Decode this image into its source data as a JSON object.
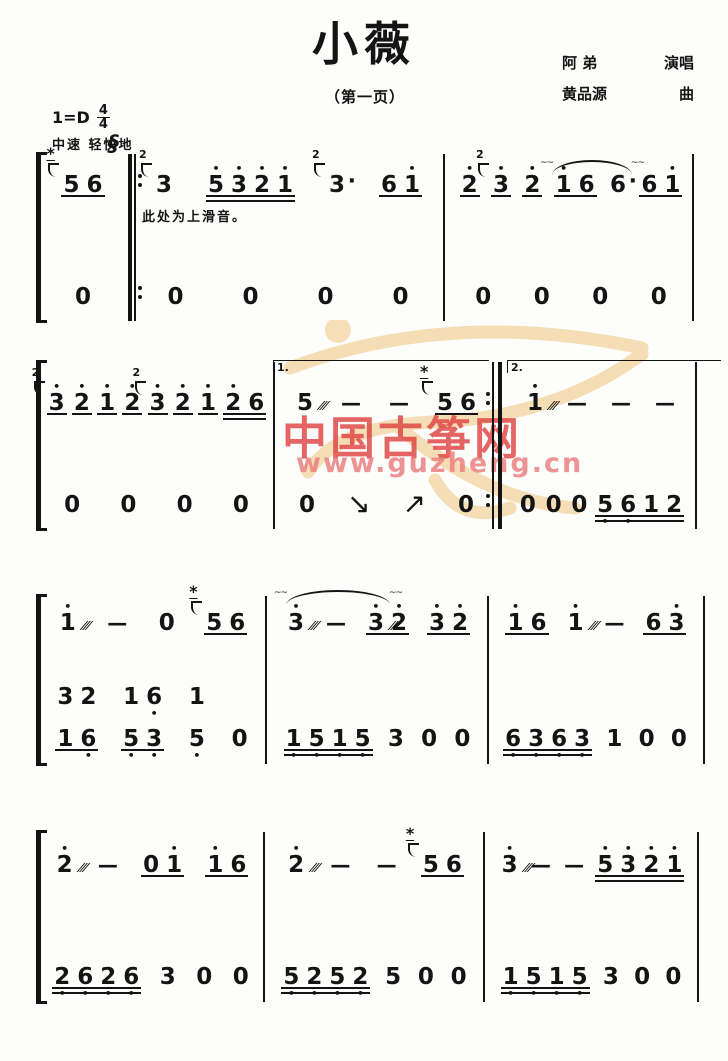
{
  "header": {
    "title": "小薇",
    "page_label": "（第一页）",
    "credits": [
      {
        "name": "阿  弟",
        "role": "演唱"
      },
      {
        "name": "黄品源",
        "role": "曲"
      }
    ],
    "key": "1=D",
    "time_num": "4",
    "time_den": "4",
    "tempo": "中速  轻快地"
  },
  "watermark": {
    "brand": "中国古筝网",
    "url": "www.guzheng.cn"
  },
  "systems": [
    {
      "annotation": "此处为上滑音。",
      "upper": [
        [
          {
            "ul": 1,
            "notes": [
              {
                "t": "5",
                "orn": 1,
                "lab": "*"
              },
              {
                "t": "6"
              }
            ]
          }
        ],
        [
          {
            "ul": 0,
            "notes": [
              {
                "t": "3",
                "orn": 1,
                "lab": "2"
              }
            ]
          },
          {
            "ul": 2,
            "notes": [
              {
                "t": "5",
                "hi": 1
              },
              {
                "t": "3",
                "hi": 1
              },
              {
                "t": "2",
                "hi": 1
              },
              {
                "t": "1",
                "hi": 1
              }
            ]
          },
          {
            "ul": 0,
            "notes": [
              {
                "t": "3",
                "orn": 1,
                "lab": "2",
                "aug": true
              }
            ]
          },
          {
            "ul": 1,
            "notes": [
              {
                "t": "6"
              },
              {
                "t": "1",
                "hi": 1
              }
            ]
          }
        ],
        [
          {
            "ul": 1,
            "notes": [
              {
                "t": "2",
                "hi": 1
              }
            ]
          },
          {
            "ul": 1,
            "notes": [
              {
                "t": "3",
                "hi": 1,
                "orn": 1,
                "lab": "2̇"
              }
            ]
          },
          {
            "ul": 1,
            "notes": [
              {
                "t": "2",
                "hi": 1
              }
            ]
          },
          {
            "ul": 1,
            "notes": [
              {
                "t": "1",
                "hi": 1
              },
              {
                "t": "6"
              }
            ]
          },
          {
            "ul": 0,
            "notes": [
              {
                "t": "6",
                "aug": true
              }
            ]
          },
          {
            "ul": 1,
            "notes": [
              {
                "t": "6"
              },
              {
                "t": "1",
                "hi": 1
              }
            ]
          }
        ]
      ],
      "lower": [
        [
          {
            "ul": 0,
            "notes": [
              {
                "t": "0"
              }
            ]
          }
        ],
        [
          {
            "ul": 0,
            "notes": [
              {
                "t": "0"
              }
            ]
          },
          {
            "ul": 0,
            "notes": [
              {
                "t": "0"
              }
            ]
          },
          {
            "ul": 0,
            "notes": [
              {
                "t": "0"
              }
            ]
          },
          {
            "ul": 0,
            "notes": [
              {
                "t": "0"
              }
            ]
          }
        ],
        [
          {
            "ul": 0,
            "notes": [
              {
                "t": "0"
              }
            ]
          },
          {
            "ul": 0,
            "notes": [
              {
                "t": "0"
              }
            ]
          },
          {
            "ul": 0,
            "notes": [
              {
                "t": "0"
              }
            ]
          },
          {
            "ul": 0,
            "notes": [
              {
                "t": "0"
              }
            ]
          }
        ]
      ]
    },
    {
      "voltas": [
        "1.",
        "2."
      ],
      "upper": [
        [
          {
            "ul": 1,
            "notes": [
              {
                "t": "3",
                "hi": 1,
                "orn": 1,
                "lab": "2"
              }
            ]
          },
          {
            "ul": 1,
            "notes": [
              {
                "t": "2",
                "hi": 1
              }
            ]
          },
          {
            "ul": 1,
            "notes": [
              {
                "t": "1",
                "hi": 1
              }
            ]
          },
          {
            "ul": 1,
            "notes": [
              {
                "t": "2",
                "hi": 1
              }
            ]
          },
          {
            "ul": 1,
            "notes": [
              {
                "t": "3",
                "hi": 1,
                "orn": 1,
                "lab": "2"
              }
            ]
          },
          {
            "ul": 1,
            "notes": [
              {
                "t": "2",
                "hi": 1
              }
            ]
          },
          {
            "ul": 1,
            "notes": [
              {
                "t": "1",
                "hi": 1
              }
            ]
          },
          {
            "ul": 2,
            "notes": [
              {
                "t": "2",
                "hi": 1
              },
              {
                "t": "6"
              }
            ]
          }
        ],
        [
          {
            "ul": 0,
            "notes": [
              {
                "t": "5",
                "trem": true
              }
            ]
          },
          {
            "ul": 0,
            "notes": [
              {
                "t": "—"
              }
            ]
          },
          {
            "ul": 0,
            "notes": [
              {
                "t": "—"
              }
            ]
          },
          {
            "ul": 1,
            "notes": [
              {
                "t": "5",
                "orn": 1,
                "lab": "*"
              },
              {
                "t": "6"
              }
            ]
          }
        ],
        [
          {
            "ul": 0,
            "notes": [
              {
                "t": "1",
                "hi": 1,
                "trem": true
              }
            ]
          },
          {
            "ul": 0,
            "notes": [
              {
                "t": "—"
              }
            ]
          },
          {
            "ul": 0,
            "notes": [
              {
                "t": "—"
              }
            ]
          },
          {
            "ul": 0,
            "notes": [
              {
                "t": "—"
              }
            ]
          }
        ]
      ],
      "lower": [
        [
          {
            "ul": 0,
            "notes": [
              {
                "t": "0"
              }
            ]
          },
          {
            "ul": 0,
            "notes": [
              {
                "t": "0"
              }
            ]
          },
          {
            "ul": 0,
            "notes": [
              {
                "t": "0"
              }
            ]
          },
          {
            "ul": 0,
            "notes": [
              {
                "t": "0"
              }
            ]
          }
        ],
        [
          {
            "ul": 0,
            "notes": [
              {
                "t": "0"
              }
            ]
          },
          {
            "ul": 0,
            "notes": [
              {
                "t": "↘",
                "arrow": true
              }
            ]
          },
          {
            "ul": 0,
            "notes": [
              {
                "t": "↗",
                "arrow": true
              }
            ]
          },
          {
            "ul": 0,
            "notes": [
              {
                "t": "0"
              }
            ]
          }
        ],
        [
          {
            "ul": 0,
            "notes": [
              {
                "t": "0"
              }
            ]
          },
          {
            "ul": 0,
            "notes": [
              {
                "t": "0"
              }
            ]
          },
          {
            "ul": 0,
            "notes": [
              {
                "t": "0"
              }
            ]
          },
          {
            "ul": 2,
            "notes": [
              {
                "t": "5",
                "lo": 1
              },
              {
                "t": "6",
                "lo": 1
              },
              {
                "t": "1"
              },
              {
                "t": "2"
              }
            ]
          }
        ]
      ]
    },
    {
      "upper": [
        [
          {
            "ul": 0,
            "notes": [
              {
                "t": "1",
                "hi": 1,
                "trem": true
              }
            ]
          },
          {
            "ul": 0,
            "notes": [
              {
                "t": "—"
              }
            ]
          },
          {
            "ul": 0,
            "notes": [
              {
                "t": "0"
              }
            ]
          },
          {
            "ul": 1,
            "notes": [
              {
                "t": "5",
                "orn": 1,
                "lab": "*"
              },
              {
                "t": "6"
              }
            ]
          }
        ],
        [
          {
            "ul": 0,
            "notes": [
              {
                "t": "3",
                "hi": 1,
                "trem": true
              }
            ]
          },
          {
            "ul": 0,
            "notes": [
              {
                "t": "—"
              }
            ]
          },
          {
            "ul": 1,
            "notes": [
              {
                "t": "3",
                "hi": 1,
                "trem": true
              },
              {
                "t": "2",
                "hi": 1
              }
            ]
          },
          {
            "ul": 1,
            "notes": [
              {
                "t": "3",
                "hi": 1
              },
              {
                "t": "2",
                "hi": 1
              }
            ]
          }
        ],
        [
          {
            "ul": 1,
            "notes": [
              {
                "t": "1",
                "hi": 1
              },
              {
                "t": "6"
              }
            ]
          },
          {
            "ul": 0,
            "notes": [
              {
                "t": "1",
                "hi": 1,
                "trem": true
              }
            ]
          },
          {
            "ul": 0,
            "notes": [
              {
                "t": "—"
              }
            ]
          },
          {
            "ul": 1,
            "notes": [
              {
                "t": "6"
              },
              {
                "t": "3",
                "hi": 1
              }
            ]
          }
        ]
      ],
      "lower": [
        [
          {
            "ul": 1,
            "chords": [
              [
                {
                  "t": "3"
                },
                {
                  "t": "1"
                }
              ],
              [
                {
                  "t": "2"
                },
                {
                  "t": "6",
                  "lo": 1
                }
              ]
            ]
          },
          {
            "ul": 1,
            "chords": [
              [
                {
                  "t": "1"
                },
                {
                  "t": "5",
                  "lo": 1
                }
              ],
              [
                {
                  "t": "6",
                  "lo": 1
                },
                {
                  "t": "3",
                  "lo": 1
                }
              ]
            ]
          },
          {
            "ul": 0,
            "chords": [
              [
                {
                  "t": "1"
                },
                {
                  "t": "5",
                  "lo": 1
                }
              ]
            ]
          },
          {
            "ul": 0,
            "notes": [
              {
                "t": "0"
              }
            ]
          }
        ],
        [
          {
            "ul": 2,
            "notes": [
              {
                "t": "1",
                "lo": 1
              },
              {
                "t": "5",
                "lo": 1
              },
              {
                "t": "1",
                "lo": 1
              },
              {
                "t": "5",
                "lo": 1
              }
            ]
          },
          {
            "ul": 0,
            "notes": [
              {
                "t": "3"
              }
            ]
          },
          {
            "ul": 0,
            "notes": [
              {
                "t": "0"
              }
            ]
          },
          {
            "ul": 0,
            "notes": [
              {
                "t": "0"
              }
            ]
          }
        ],
        [
          {
            "ul": 2,
            "notes": [
              {
                "t": "6",
                "lo": 1
              },
              {
                "t": "3",
                "lo": 1
              },
              {
                "t": "6",
                "lo": 1
              },
              {
                "t": "3",
                "lo": 1
              }
            ]
          },
          {
            "ul": 0,
            "notes": [
              {
                "t": "1"
              }
            ]
          },
          {
            "ul": 0,
            "notes": [
              {
                "t": "0"
              }
            ]
          },
          {
            "ul": 0,
            "notes": [
              {
                "t": "0"
              }
            ]
          }
        ]
      ]
    },
    {
      "upper": [
        [
          {
            "ul": 0,
            "notes": [
              {
                "t": "2",
                "hi": 1,
                "trem": true
              }
            ]
          },
          {
            "ul": 0,
            "notes": [
              {
                "t": "—"
              }
            ]
          },
          {
            "ul": 1,
            "notes": [
              {
                "t": "0"
              },
              {
                "t": "1",
                "hi": 1
              }
            ]
          },
          {
            "ul": 1,
            "notes": [
              {
                "t": "1",
                "hi": 1
              },
              {
                "t": "6"
              }
            ]
          }
        ],
        [
          {
            "ul": 0,
            "notes": [
              {
                "t": "2",
                "hi": 1,
                "trem": true
              }
            ]
          },
          {
            "ul": 0,
            "notes": [
              {
                "t": "—"
              }
            ]
          },
          {
            "ul": 0,
            "notes": [
              {
                "t": "—"
              }
            ]
          },
          {
            "ul": 1,
            "notes": [
              {
                "t": "5",
                "orn": 1,
                "lab": "*"
              },
              {
                "t": "6"
              }
            ]
          }
        ],
        [
          {
            "ul": 0,
            "notes": [
              {
                "t": "3",
                "hi": 1,
                "trem": true
              }
            ]
          },
          {
            "ul": 0,
            "notes": [
              {
                "t": "—"
              }
            ]
          },
          {
            "ul": 0,
            "notes": [
              {
                "t": "—"
              }
            ]
          },
          {
            "ul": 2,
            "notes": [
              {
                "t": "5",
                "hi": 1
              },
              {
                "t": "3",
                "hi": 1
              },
              {
                "t": "2",
                "hi": 1
              },
              {
                "t": "1",
                "hi": 1
              }
            ]
          }
        ]
      ],
      "lower": [
        [
          {
            "ul": 2,
            "notes": [
              {
                "t": "2",
                "lo": 1
              },
              {
                "t": "6",
                "lo": 1
              },
              {
                "t": "2",
                "lo": 1
              },
              {
                "t": "6",
                "lo": 1
              }
            ]
          },
          {
            "ul": 0,
            "notes": [
              {
                "t": "3"
              }
            ]
          },
          {
            "ul": 0,
            "notes": [
              {
                "t": "0"
              }
            ]
          },
          {
            "ul": 0,
            "notes": [
              {
                "t": "0"
              }
            ]
          }
        ],
        [
          {
            "ul": 2,
            "notes": [
              {
                "t": "5",
                "lo": 1
              },
              {
                "t": "2",
                "lo": 1
              },
              {
                "t": "5",
                "lo": 1
              },
              {
                "t": "2",
                "lo": 1
              }
            ]
          },
          {
            "ul": 0,
            "notes": [
              {
                "t": "5"
              }
            ]
          },
          {
            "ul": 0,
            "notes": [
              {
                "t": "0"
              }
            ]
          },
          {
            "ul": 0,
            "notes": [
              {
                "t": "0"
              }
            ]
          }
        ],
        [
          {
            "ul": 2,
            "notes": [
              {
                "t": "1",
                "lo": 1
              },
              {
                "t": "5",
                "lo": 1
              },
              {
                "t": "1",
                "lo": 1
              },
              {
                "t": "5",
                "lo": 1
              }
            ]
          },
          {
            "ul": 0,
            "notes": [
              {
                "t": "3"
              }
            ]
          },
          {
            "ul": 0,
            "notes": [
              {
                "t": "0"
              }
            ]
          },
          {
            "ul": 0,
            "notes": [
              {
                "t": "0"
              }
            ]
          }
        ]
      ]
    }
  ]
}
